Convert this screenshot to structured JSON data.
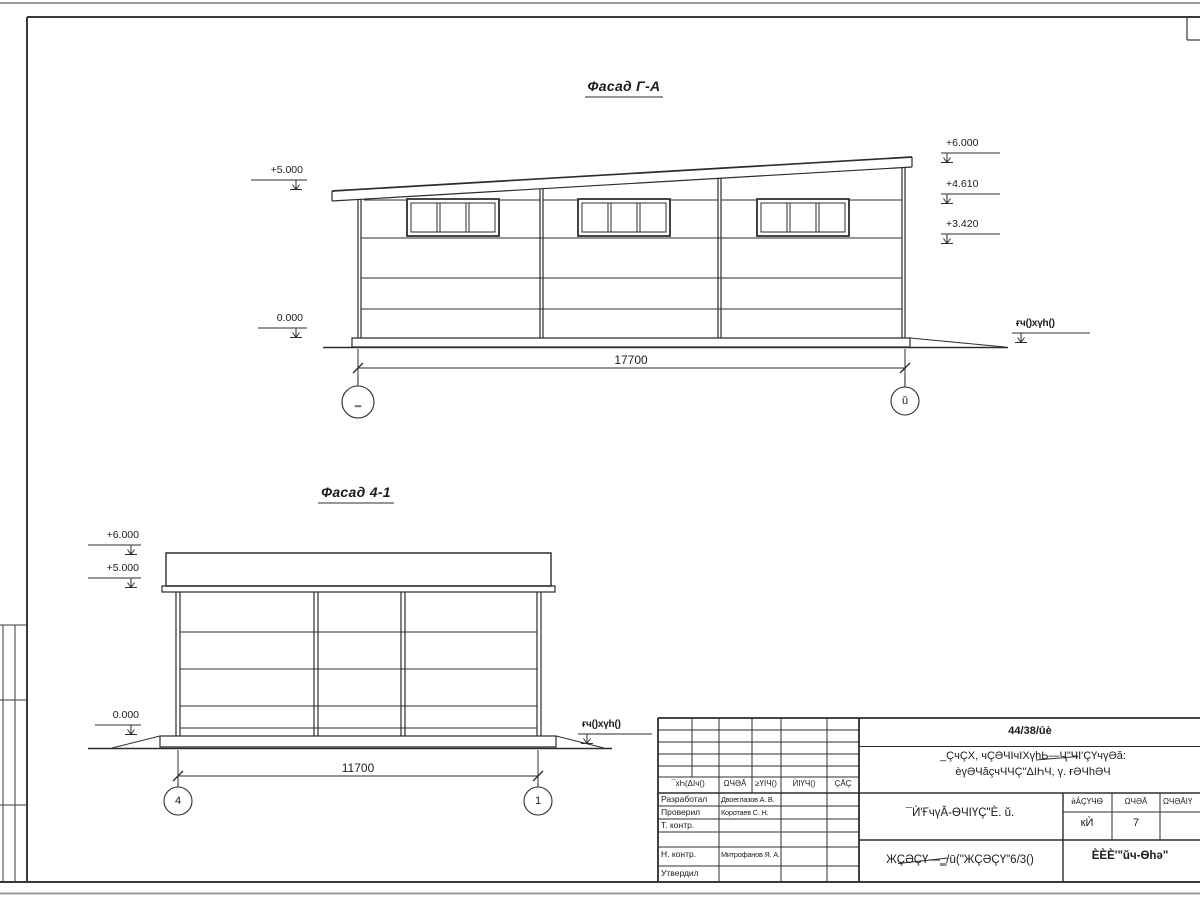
{
  "colors": {
    "line": "#2d2d2d",
    "frame": "#3a3a3a",
    "sheet_edge": "#999999"
  },
  "drawing1": {
    "title": "Фасад Г-А",
    "dimension": "17700",
    "axis_left": "‗",
    "axis_right": "ŭ",
    "mark_plus5": "+5.000",
    "mark_zero": "0.000",
    "mark_plus6": "+6.000",
    "mark_plus461": "+4.610",
    "mark_plus342": "+3.420",
    "ground_label": "ғч()хүh()"
  },
  "drawing2": {
    "title": "Фасад 4-1",
    "dimension": "11700",
    "axis_left": "4",
    "axis_right": "1",
    "mark_plus6": "+6.000",
    "mark_plus5": "+5.000",
    "mark_zero": "0.000",
    "ground_label": "ғч()хүh()"
  },
  "titleblock": {
    "doc_number": "44/38/ūè",
    "project_line1": "_ÇчÇХ, чÇӘЧIчIХүhЬ—Ҷ\"ЧI'ÇҮчүӘă:",
    "project_line2": "èүӘЧăçчЧЧÇ\"ΔIҺЧ, ү. ғӘЧhӘЧ",
    "sheet_title": "¯Ѝ'ҒчүĂ-ѲЧIҮÇ\"È. ŭ.",
    "doc_code": "ЖÇӘÇҮ—‗/ū(\"ЖÇӘÇҮ\"6/3()",
    "org_name": "ÈÈÈ'\"ŭч-Ѳhә\"",
    "cols": {
      "c1": "¯хҺ(ΔIч()",
      "c2": "ΩЧӘĂ",
      "c3": "≥ҮIЧ()",
      "c4": "ЍIҮЧ()",
      "c5": "ÇĂÇ"
    },
    "stadia": {
      "h1": "ѝǺÇҮЧѲ",
      "h2": "ΩЧӘĂ",
      "h3": "ΩЧӘĂIҮ",
      "stage": "кЍ",
      "sheet_no": "7"
    },
    "rows": [
      {
        "role": "Разработал",
        "name": "Двоеглазов А. В."
      },
      {
        "role": "Проверил",
        "name": "Коротаев С. Н."
      },
      {
        "role": "Т. контр.",
        "name": ""
      },
      {
        "role": "Н. контр.",
        "name": "Митрофанов Я. А."
      },
      {
        "role": "Утвердил",
        "name": ""
      }
    ]
  }
}
